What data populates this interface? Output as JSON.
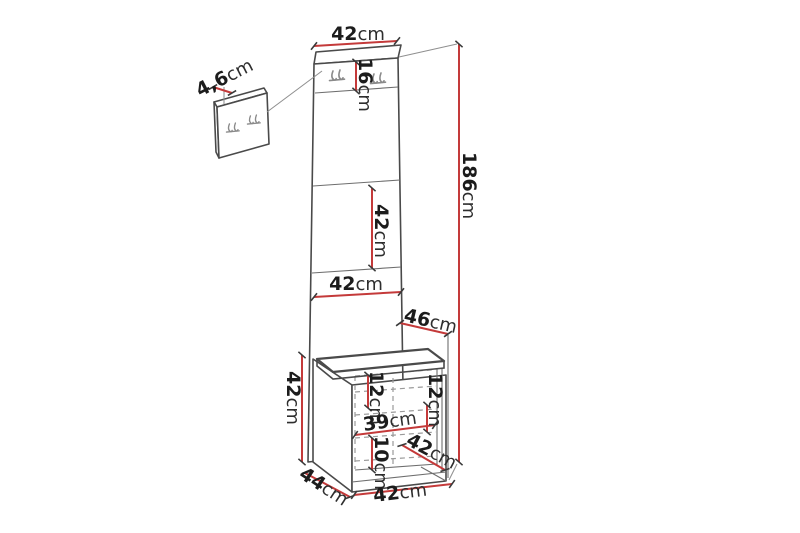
{
  "diagram": {
    "title": "hallway-furniture-dimension-diagram",
    "colors": {
      "dimension_line": "#c43a3a",
      "structure_line": "#4a4a4a",
      "hidden_line": "#9a9a9a",
      "text": "#1c1c1c",
      "background": "#ffffff"
    },
    "icons": {
      "hook": "coat-hook-icon"
    }
  },
  "dimensions": {
    "top_width": {
      "value": "42",
      "unit": "cm"
    },
    "hook_strip_height": {
      "value": "16",
      "unit": "cm"
    },
    "small_panel_depth": {
      "value": "4,6",
      "unit": "cm"
    },
    "total_height": {
      "value": "186",
      "unit": "cm"
    },
    "mid_panel_height": {
      "value": "42",
      "unit": "cm"
    },
    "lower_panel_width": {
      "value": "42",
      "unit": "cm"
    },
    "seat_depth": {
      "value": "46",
      "unit": "cm"
    },
    "bench_height": {
      "value": "42",
      "unit": "cm"
    },
    "shelf_gap_left": {
      "value": "12",
      "unit": "cm"
    },
    "shelf_gap_right": {
      "value": "12",
      "unit": "cm"
    },
    "shelf_width": {
      "value": "39",
      "unit": "cm"
    },
    "bottom_gap": {
      "value": "10",
      "unit": "cm"
    },
    "bench_inner_depth": {
      "value": "42",
      "unit": "cm"
    },
    "bench_depth": {
      "value": "44",
      "unit": "cm"
    },
    "bench_width": {
      "value": "42",
      "unit": "cm"
    }
  }
}
